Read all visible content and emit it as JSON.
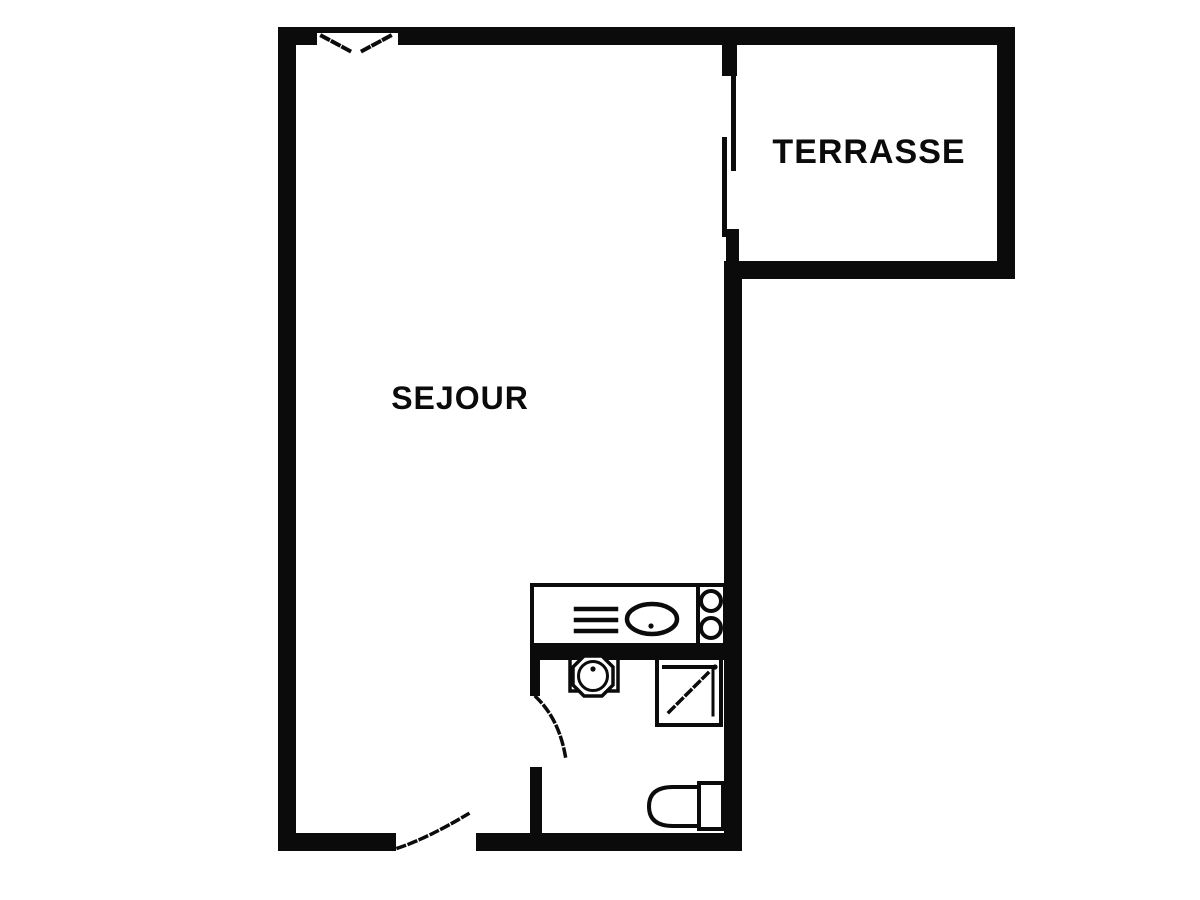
{
  "title": "Studio floor plan",
  "rooms": {
    "sejour": {
      "label": "SEJOUR"
    },
    "terrasse": {
      "label": "TERRASSE"
    }
  },
  "fixtures": {
    "kitchenette": [
      "counter",
      "drainer",
      "sink",
      "two-burner-hob"
    ],
    "bathroom": [
      "washbasin",
      "shower",
      "toilet"
    ]
  },
  "openings": [
    "window-top",
    "sliding-door-terrace",
    "bathroom-door",
    "entrance-door"
  ],
  "colors": {
    "wall": "#0b0b0b",
    "background": "#ffffff"
  }
}
